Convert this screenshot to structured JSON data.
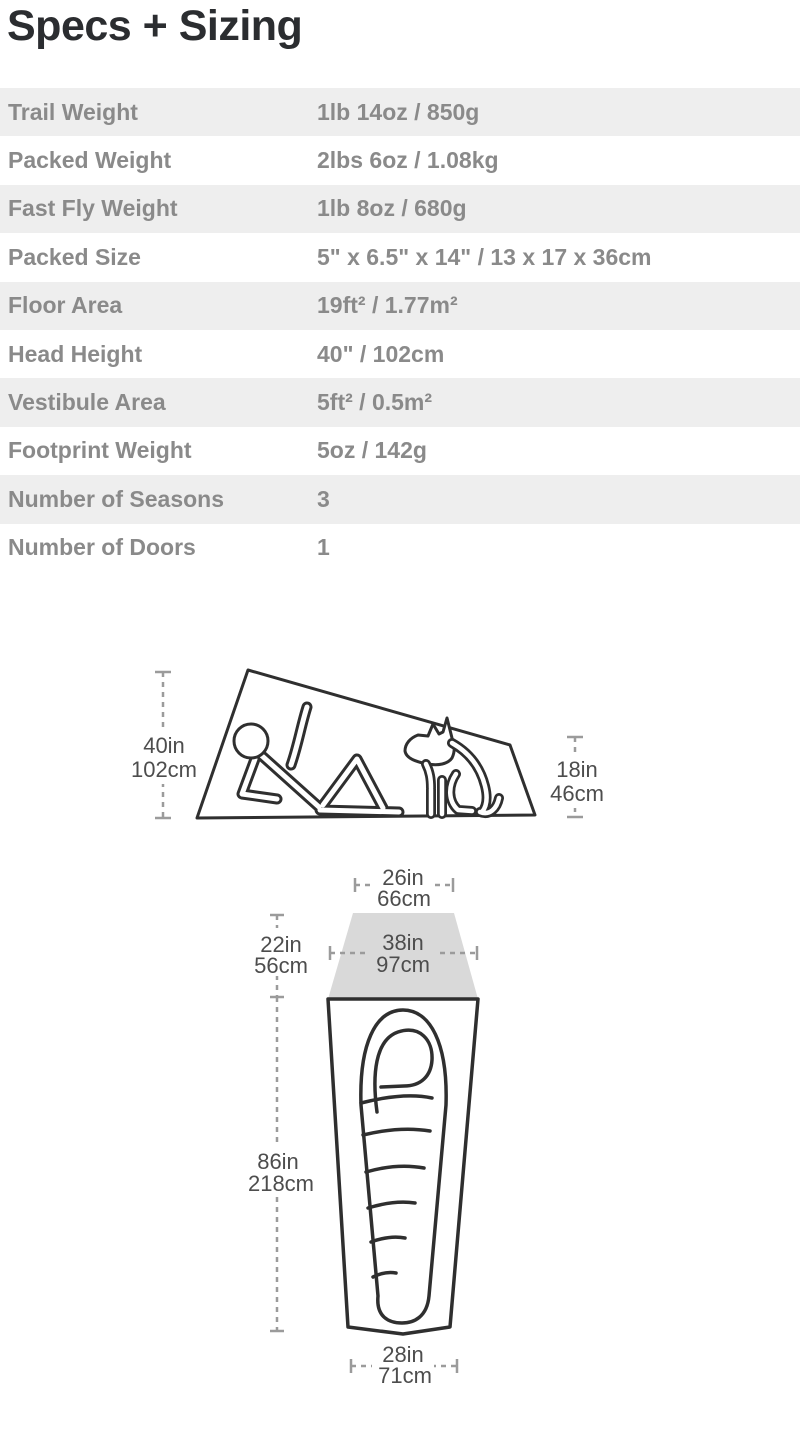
{
  "page": {
    "title": "Specs + Sizing"
  },
  "colors": {
    "title_text": "#2b2d30",
    "table_row_alt_bg": "#eeeeee",
    "table_text": "#8a8a8a",
    "diagram_stroke": "#2f2f2f",
    "dimension_gray": "#9b9b9b",
    "diagram_label_text": "#4d4d4d",
    "vestibule_fill": "#d9d9d9"
  },
  "specs_table": {
    "rows": [
      {
        "label": "Trail Weight",
        "value": "1lb 14oz / 850g"
      },
      {
        "label": "Packed Weight",
        "value": "2lbs 6oz / 1.08kg"
      },
      {
        "label": "Fast Fly Weight",
        "value": "1lb 8oz / 680g"
      },
      {
        "label": "Packed Size",
        "value": "5\" x 6.5\" x 14\" / 13 x 17 x 36cm"
      },
      {
        "label": "Floor Area",
        "value": "19ft² / 1.77m²"
      },
      {
        "label": "Head Height",
        "value": "40\" / 102cm"
      },
      {
        "label": "Vestibule Area",
        "value": "5ft² / 0.5m²"
      },
      {
        "label": "Footprint Weight",
        "value": "5oz / 142g"
      },
      {
        "label": "Number of Seasons",
        "value": "3"
      },
      {
        "label": "Number of Doors",
        "value": "1"
      }
    ]
  },
  "diagrams": {
    "side_view": {
      "height": {
        "in": "40in",
        "cm": "102cm"
      },
      "foot_height": {
        "in": "18in",
        "cm": "46cm"
      }
    },
    "floor_plan": {
      "head_top_width": {
        "in": "26in",
        "cm": "66cm"
      },
      "head_width": {
        "in": "38in",
        "cm": "97cm"
      },
      "vestibule_depth": {
        "in": "22in",
        "cm": "56cm"
      },
      "floor_length": {
        "in": "86in",
        "cm": "218cm"
      },
      "foot_width": {
        "in": "28in",
        "cm": "71cm"
      }
    }
  }
}
